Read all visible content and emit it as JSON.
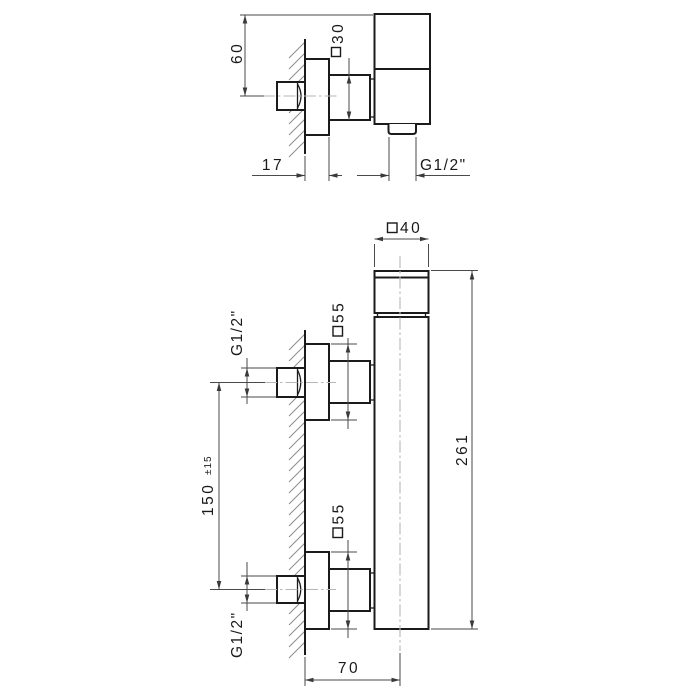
{
  "side_view": {
    "labels": {
      "height": "60",
      "square30": "30",
      "offset": "17",
      "outlet_thread": "G1/2\""
    }
  },
  "front_view": {
    "labels": {
      "square40": "40",
      "square55_top": "55",
      "square55_bottom": "55",
      "thread_top": "G1/2\"",
      "thread_bottom": "G1/2\"",
      "spacing": "150",
      "spacing_tolerance": "±15",
      "height": "261",
      "depth": "70"
    }
  },
  "meta": {
    "square_symbol": "□",
    "object_line_color": "#1b1b1b",
    "dimension_line_color": "#4a4a4a",
    "centerline_color": "#b6b6b6",
    "hatch_color": "#8c8c8c",
    "background_color": "#ffffff"
  }
}
